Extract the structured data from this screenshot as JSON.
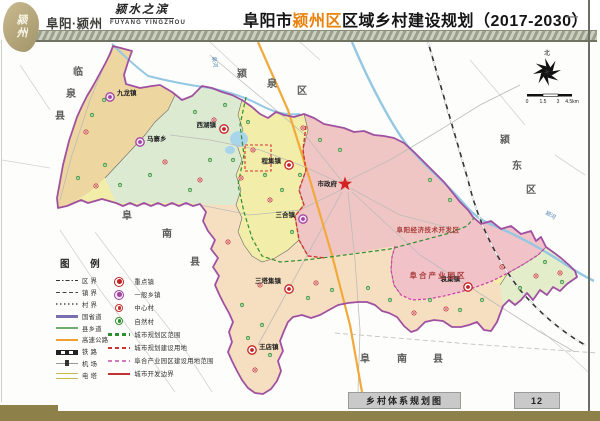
{
  "header": {
    "logo_chars": "颍州",
    "brand": "阜阳·颍州",
    "slogan": "颍水之滨",
    "slogan_en": "FUYANG YINGZHOU",
    "title_prefix": "阜阳市",
    "title_highlight": "颍州区",
    "title_suffix": "区域乡村建设规划（2017-2030）",
    "highlight_color": "#e8820c",
    "dash": "—"
  },
  "map": {
    "neighbors": [
      {
        "name": "linquan-county",
        "chars": [
          "临",
          "泉",
          "县"
        ],
        "pos": [
          [
            73,
            75
          ],
          [
            66,
            97
          ],
          [
            55,
            119
          ]
        ]
      },
      {
        "name": "yingquan-district",
        "chars": [
          "颍",
          "泉",
          "区"
        ],
        "pos": [
          [
            237,
            77
          ],
          [
            267,
            87
          ],
          [
            297,
            94
          ]
        ]
      },
      {
        "name": "yingdong-district",
        "chars": [
          "颍",
          "东",
          "区"
        ],
        "pos": [
          [
            500,
            143
          ],
          [
            512,
            169
          ],
          [
            526,
            193
          ]
        ]
      },
      {
        "name": "funan-county-west",
        "chars": [
          "阜",
          "南",
          "县"
        ],
        "pos": [
          [
            122,
            219
          ],
          [
            162,
            237
          ],
          [
            190,
            265
          ]
        ]
      },
      {
        "name": "funan-county-south",
        "chars": [
          "阜",
          "南",
          "县"
        ],
        "pos": [
          [
            360,
            362
          ],
          [
            397,
            362
          ],
          [
            433,
            362
          ]
        ]
      }
    ],
    "towns": [
      {
        "name": "九龙镇",
        "type": "township",
        "x": 110,
        "y": 97,
        "lx": 117,
        "ly": 95,
        "anchor": "start"
      },
      {
        "name": "马寨乡",
        "type": "township",
        "x": 140,
        "y": 142,
        "lx": 147,
        "ly": 141,
        "anchor": "start"
      },
      {
        "name": "西湖镇",
        "type": "key",
        "x": 224,
        "y": 129,
        "lx": 216,
        "ly": 127,
        "anchor": "end"
      },
      {
        "name": "程集镇",
        "type": "key",
        "x": 289,
        "y": 165,
        "lx": 281,
        "ly": 163,
        "anchor": "end"
      },
      {
        "name": "三合镇",
        "type": "township",
        "x": 303,
        "y": 219,
        "lx": 295,
        "ly": 217,
        "anchor": "end"
      },
      {
        "name": "三塔集镇",
        "type": "key",
        "x": 289,
        "y": 289,
        "lx": 281,
        "ly": 283,
        "anchor": "end"
      },
      {
        "name": "王店镇",
        "type": "key",
        "x": 252,
        "y": 350,
        "lx": 259,
        "ly": 349,
        "anchor": "start"
      },
      {
        "name": "袁集镇",
        "type": "key",
        "x": 468,
        "y": 287,
        "lx": 460,
        "ly": 281,
        "anchor": "end"
      }
    ],
    "city": {
      "label": "市政府",
      "x": 345,
      "y": 184,
      "lx": 337,
      "ly": 186
    },
    "zones": [
      {
        "label": "阜阳经济技术开发区",
        "x": 428,
        "y": 232,
        "size": 6.5,
        "ls": 0.5,
        "color": "#a83a3a"
      },
      {
        "label": "阜合产业园区",
        "x": 438,
        "y": 278,
        "size": 7.5,
        "ls": 2,
        "color": "#a83a3a"
      }
    ],
    "rivers": [
      {
        "label": "泉河",
        "x": 212,
        "y": 57,
        "rot": 80
      },
      {
        "label": "颍河",
        "x": 545,
        "y": 214,
        "rot": 30
      }
    ],
    "villages": {
      "central": [
        [
          253,
          150
        ],
        [
          214,
          120
        ],
        [
          200,
          180
        ],
        [
          165,
          162
        ],
        [
          96,
          186
        ],
        [
          86,
          132
        ],
        [
          241,
          178
        ],
        [
          270,
          200
        ],
        [
          228,
          242
        ],
        [
          260,
          285
        ],
        [
          316,
          283
        ],
        [
          352,
          318
        ],
        [
          414,
          313
        ],
        [
          446,
          309
        ],
        [
          502,
          267
        ],
        [
          536,
          276
        ],
        [
          560,
          273
        ],
        [
          332,
          97
        ],
        [
          366,
          108
        ],
        [
          303,
          128
        ],
        [
          255,
          370
        ],
        [
          288,
          338
        ]
      ],
      "natural": [
        [
          180,
          95
        ],
        [
          195,
          112
        ],
        [
          225,
          105
        ],
        [
          248,
          122
        ],
        [
          233,
          160
        ],
        [
          210,
          160
        ],
        [
          190,
          190
        ],
        [
          150,
          175
        ],
        [
          120,
          185
        ],
        [
          105,
          165
        ],
        [
          78,
          178
        ],
        [
          92,
          115
        ],
        [
          104,
          100
        ],
        [
          265,
          175
        ],
        [
          282,
          190
        ],
        [
          300,
          175
        ],
        [
          320,
          140
        ],
        [
          340,
          150
        ],
        [
          292,
          232
        ],
        [
          308,
          298
        ],
        [
          332,
          290
        ],
        [
          368,
          288
        ],
        [
          390,
          300
        ],
        [
          430,
          300
        ],
        [
          460,
          310
        ],
        [
          482,
          300
        ],
        [
          520,
          288
        ],
        [
          545,
          262
        ],
        [
          562,
          282
        ],
        [
          242,
          305
        ],
        [
          262,
          325
        ],
        [
          270,
          355
        ],
        [
          248,
          338
        ],
        [
          430,
          180
        ],
        [
          450,
          200
        ],
        [
          360,
          95
        ],
        [
          390,
          120
        ]
      ]
    },
    "compass": {
      "label": "北"
    },
    "scale": {
      "ticks": [
        "0",
        "1.5",
        "3",
        "4.5km"
      ],
      "xs": [
        527,
        543,
        558,
        572
      ],
      "y": 103
    }
  },
  "legend": {
    "title": "图  例",
    "left": [
      {
        "label": "区  界",
        "sample": "boundary-district"
      },
      {
        "label": "镇  界",
        "sample": "boundary-town"
      },
      {
        "label": "村  界",
        "sample": "boundary-village"
      },
      {
        "label": "国省道",
        "sample": "road-national"
      },
      {
        "label": "县乡道",
        "sample": "road-county"
      },
      {
        "label": "高速公路",
        "sample": "road-expressway"
      },
      {
        "label": "铁  路",
        "sample": "railway"
      },
      {
        "label": "机  场",
        "sample": "airport"
      },
      {
        "label": "电  塔",
        "sample": "powerline"
      }
    ],
    "right": [
      {
        "label": "重点镇",
        "icon": "key"
      },
      {
        "label": "一般乡镇",
        "icon": "town"
      },
      {
        "label": "中心村",
        "icon": "cv"
      },
      {
        "label": "自然村",
        "icon": "nv"
      },
      {
        "label": "城市规划区范围",
        "sample": "dash-green"
      },
      {
        "label": "城市规划建设用地",
        "sample": "dash-red"
      },
      {
        "label": "阜合产业园区建设用地范围",
        "sample": "dash-pink"
      },
      {
        "label": "城市开发边界",
        "sample": "line-red"
      }
    ]
  },
  "footer": {
    "map_title": "乡村体系规划图",
    "page_number": "12"
  }
}
